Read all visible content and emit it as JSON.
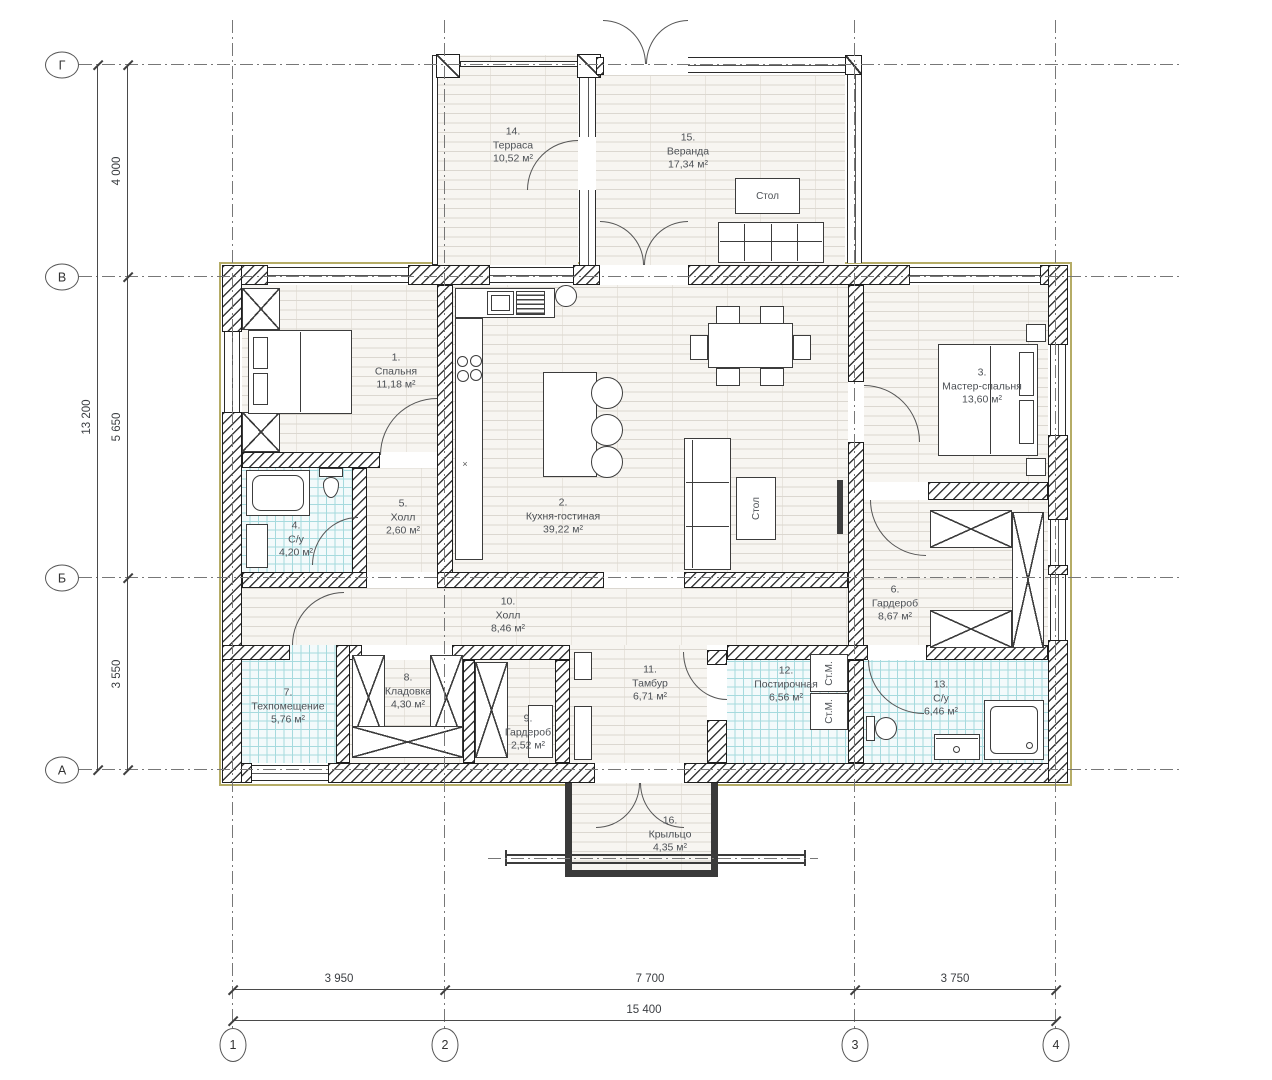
{
  "drawing": {
    "type": "architectural floor plan"
  },
  "rooms": [
    {
      "number": "1.",
      "name": "Спальня",
      "area": "11,18 м²"
    },
    {
      "number": "2.",
      "name": "Кухня-гостиная",
      "area": "39,22 м²"
    },
    {
      "number": "3.",
      "name": "Мастер-спальня",
      "area": "13,60 м²"
    },
    {
      "number": "4.",
      "name": "С/у",
      "area": "4,20 м²"
    },
    {
      "number": "5.",
      "name": "Холл",
      "area": "2,60 м²"
    },
    {
      "number": "6.",
      "name": "Гардероб",
      "area": "8,67 м²"
    },
    {
      "number": "7.",
      "name": "Техпомещение",
      "area": "5,76 м²"
    },
    {
      "number": "8.",
      "name": "Кладовка",
      "area": "4,30 м²"
    },
    {
      "number": "9.",
      "name": "Гардероб",
      "area": "2,52 м²"
    },
    {
      "number": "10.",
      "name": "Холл",
      "area": "8,46 м²"
    },
    {
      "number": "11.",
      "name": "Тамбур",
      "area": "6,71 м²"
    },
    {
      "number": "12.",
      "name": "Постирочная",
      "area": "6,56 м²"
    },
    {
      "number": "13.",
      "name": "С/у",
      "area": "6,46 м²"
    },
    {
      "number": "14.",
      "name": "Терраса",
      "area": "10,52 м²"
    },
    {
      "number": "15.",
      "name": "Веранда",
      "area": "17,34 м²"
    },
    {
      "number": "16.",
      "name": "Крыльцо",
      "area": "4,35 м²"
    }
  ],
  "furniture_labels": {
    "table": "Стол",
    "washer": "Ст.М.",
    "cross": "×"
  },
  "axes": {
    "rows": [
      "Г",
      "В",
      "Б",
      "А"
    ],
    "cols": [
      "1",
      "2",
      "3",
      "4"
    ]
  },
  "dimensions": {
    "left_total": "13 200",
    "left_segments": [
      "4 000",
      "5 650",
      "3 550"
    ],
    "bottom_segments": [
      "3 950",
      "7 700",
      "3 750"
    ],
    "bottom_total": "15 400"
  },
  "colors": {
    "wall_line": "#1e1e1e",
    "exterior_face": "#b5ac66",
    "tile_line": "#a6dade",
    "plank_line": "#dbd7d0",
    "grid_line": "#777777"
  }
}
